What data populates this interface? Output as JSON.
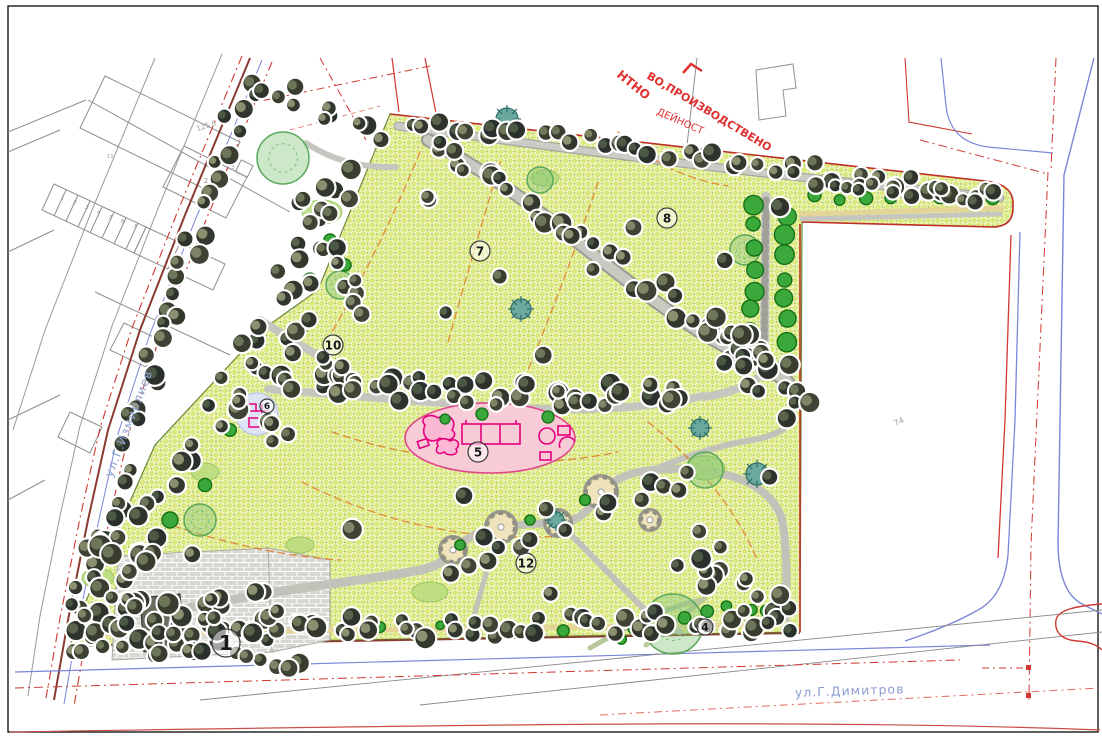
{
  "drawing": {
    "labels": {
      "street_left": "ул.Г.Измирлиев",
      "street_bottom": "ул.Г.Димитров",
      "zone_line1": "ВО,ПРОИЗВОДСТВЕНО",
      "zone_line2": "НТНО",
      "zone_line3": "ДЕЙНОСТ"
    },
    "area_markers": [
      {
        "n": "1",
        "x": 226,
        "y": 643,
        "r": 14,
        "fs": 20
      },
      {
        "n": "4",
        "x": 705,
        "y": 627,
        "r": 8,
        "fs": 11
      },
      {
        "n": "5",
        "x": 478,
        "y": 452,
        "r": 10,
        "fs": 12
      },
      {
        "n": "6",
        "x": 267,
        "y": 406,
        "r": 7,
        "fs": 9
      },
      {
        "n": "7",
        "x": 480,
        "y": 251,
        "r": 10,
        "fs": 12
      },
      {
        "n": "8",
        "x": 667,
        "y": 218,
        "r": 10,
        "fs": 12
      },
      {
        "n": "10",
        "x": 333,
        "y": 345,
        "r": 10,
        "fs": 12
      },
      {
        "n": "12",
        "x": 526,
        "y": 563,
        "r": 10,
        "fs": 12
      }
    ],
    "parcel_labels": [
      {
        "t": "125.6",
        "x": 207,
        "y": 128,
        "fs": 7,
        "rot": -18
      },
      {
        "t": "2",
        "x": 206,
        "y": 183,
        "fs": 7,
        "rot": 0
      },
      {
        "t": "3",
        "x": 233,
        "y": 169,
        "fs": 5,
        "rot": 0
      },
      {
        "t": "13",
        "x": 110,
        "y": 158,
        "fs": 5,
        "rot": 0
      },
      {
        "t": "74",
        "x": 900,
        "y": 424,
        "fs": 8,
        "rot": -25
      }
    ],
    "garage_numbers": [
      {
        "t": "1",
        "x": 62,
        "y": 199
      },
      {
        "t": "2",
        "x": 74,
        "y": 204
      },
      {
        "t": "3",
        "x": 86,
        "y": 209
      },
      {
        "t": "4",
        "x": 98,
        "y": 214
      },
      {
        "t": "5",
        "x": 110,
        "y": 219
      },
      {
        "t": "6",
        "x": 122,
        "y": 223
      },
      {
        "t": "7",
        "x": 134,
        "y": 228
      }
    ],
    "colors": {
      "lawn": "#dbe87d",
      "path_gray": "#c6c6c0",
      "tan_path": "#e4d498",
      "playground_pink": "#f8ccd6",
      "equipment_magenta": "#e6007e",
      "regulation_red": "#d03830",
      "road_blue": "#7b86d8",
      "street_text_blue": "#8c9ed2",
      "contour_orange": "#e08030",
      "tree_dark": "#2e342c",
      "tree_green": "#3aa83a",
      "zone_text_red": "#e03030",
      "cadastral_gray": "#9a9a9a",
      "boundary_brown": "#8a4030"
    }
  }
}
